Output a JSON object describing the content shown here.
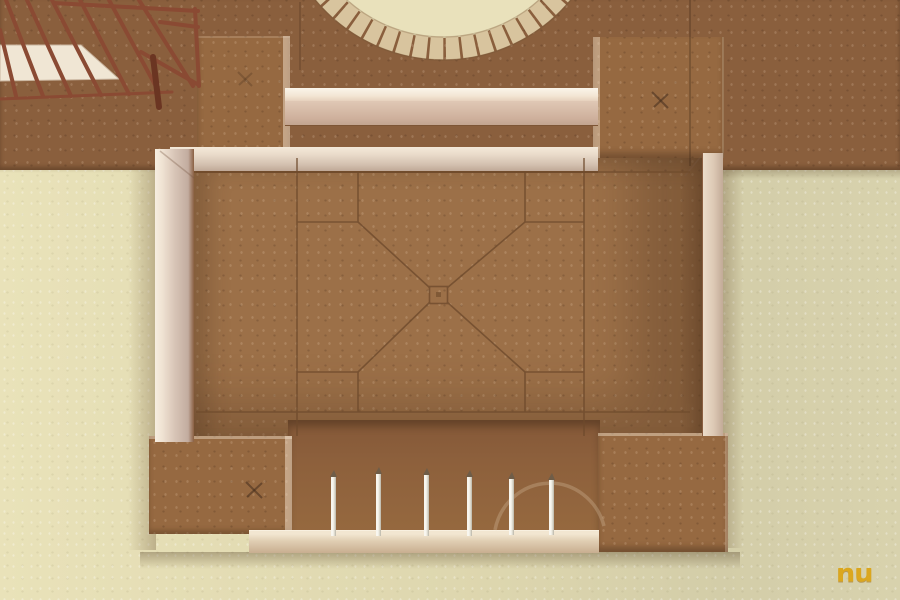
{
  "watermark": {
    "text": "nu"
  },
  "palette": {
    "mdf_backboard": "#8a5f3d",
    "courtyard_floor": "#9c7048",
    "corner_tower": "#966941",
    "foam_base": "#e0d9b2",
    "balsa_wood": "#eadcc9",
    "truss_sticks": "#8a4a33",
    "white_columns": "#f2f0e8",
    "arch_ring": "#d8c49e",
    "watermark_orange": "#dca414",
    "inscription_lines": "#6e4a2c"
  },
  "counts": {
    "corner_towers": 4,
    "white_columns": 6,
    "visible_arch_ring_segments": 17
  }
}
